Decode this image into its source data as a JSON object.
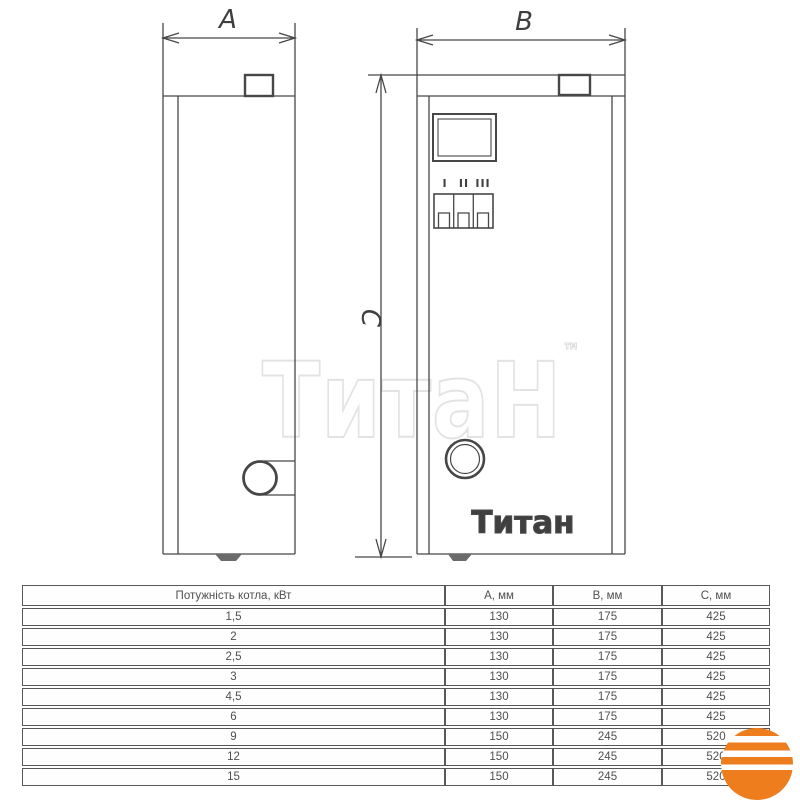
{
  "drawing": {
    "dim_a_label": "A",
    "dim_b_label": "B",
    "dim_c_label": "C",
    "switch_labels": [
      "I",
      "II",
      "III"
    ],
    "panel_logo_text": "Титан",
    "watermark_text": "ТитаН",
    "trademark": "™"
  },
  "table": {
    "headers": [
      "Потужність котла, кВт",
      "А, мм",
      "В, мм",
      "С, мм"
    ],
    "rows": [
      [
        "1,5",
        "130",
        "175",
        "425"
      ],
      [
        "2",
        "130",
        "175",
        "425"
      ],
      [
        "2,5",
        "130",
        "175",
        "425"
      ],
      [
        "3",
        "130",
        "175",
        "425"
      ],
      [
        "4,5",
        "130",
        "175",
        "425"
      ],
      [
        "6",
        "130",
        "175",
        "425"
      ],
      [
        "9",
        "150",
        "245",
        "520"
      ],
      [
        "12",
        "150",
        "245",
        "520"
      ],
      [
        "15",
        "150",
        "245",
        "520"
      ]
    ]
  },
  "colors": {
    "accent_orange": "#ee7d1d",
    "line": "#474747",
    "watermark": "#e4e3e2"
  },
  "icons": {
    "brand_logo": "striped-sun-logo"
  }
}
